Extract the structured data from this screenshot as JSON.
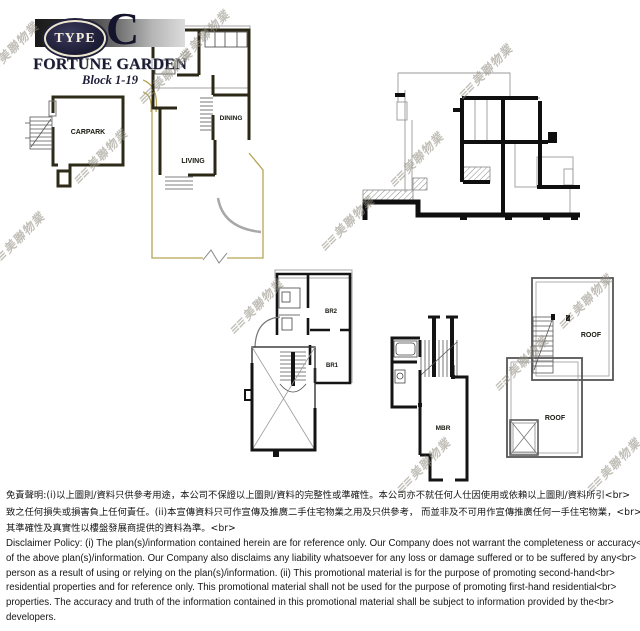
{
  "logo": {
    "type_label": "TYPE",
    "type_letter": "C",
    "estate_name": "FORTUNE GARDEN",
    "block_label": "Block 1-19"
  },
  "watermark": {
    "logo_glyph": "≡≡",
    "text": "美聯物業"
  },
  "plans": {
    "carpark_floor": {
      "carpark": "CARPARK"
    },
    "ground_floor": {
      "dining": "DINING",
      "living": "LIVING"
    },
    "bedroom_floor": {
      "br2": "BR2",
      "br1": "BR1"
    },
    "master_floor": {
      "mbr": "MBR"
    },
    "roof_floor": {
      "roof_upper": "ROOF",
      "roof_lower": "ROOF"
    }
  },
  "disclaimer": {
    "chinese_lines": [
      "免責聲明:(i)以上圖則/資料只供參考用途，本公司不保證以上圖則/資料的完整性或準確性。本公司亦不就任何人仕因使用或依賴以上圖則/資料所引<br>",
      "致之任何損失或損害負上任何責任。(ii)本宣傳資料只可作宣傳及推廣二手住宅物業之用及只供參考， 而並非及不可用作宣傳推廣任何一手住宅物業，<br>",
      "其準確性及真實性以樓盤發展商提供的資料為準。<br>"
    ],
    "english_lines": [
      "Disclaimer Policy: (i) The plan(s)/information contained herein are for reference only. Our Company does not warrant the completeness or accuracy<br>",
      "of the above plan(s)/information. Our Company also disclaims any liability whatsoever for any loss or damage suffered or to be suffered by any<br>",
      "person as a result of using or relying on the plan(s)/information. (ii) This promotional material is for the purpose of promoting second-hand<br>",
      "residential properties and for reference only. This promotional material shall not be used for the purpose of promoting first-hand residential<br>",
      "properties. The accuracy and truth of the information contained in this promotional material shall be subject to information provided by the<br>",
      "developers."
    ]
  },
  "colors": {
    "wall_dark": "#141414",
    "wall_olive": "#2e2b18",
    "garden_line": "#b8a455",
    "thin_line": "#999999",
    "watermark": "#94908a",
    "logo_text": "#14142c"
  }
}
